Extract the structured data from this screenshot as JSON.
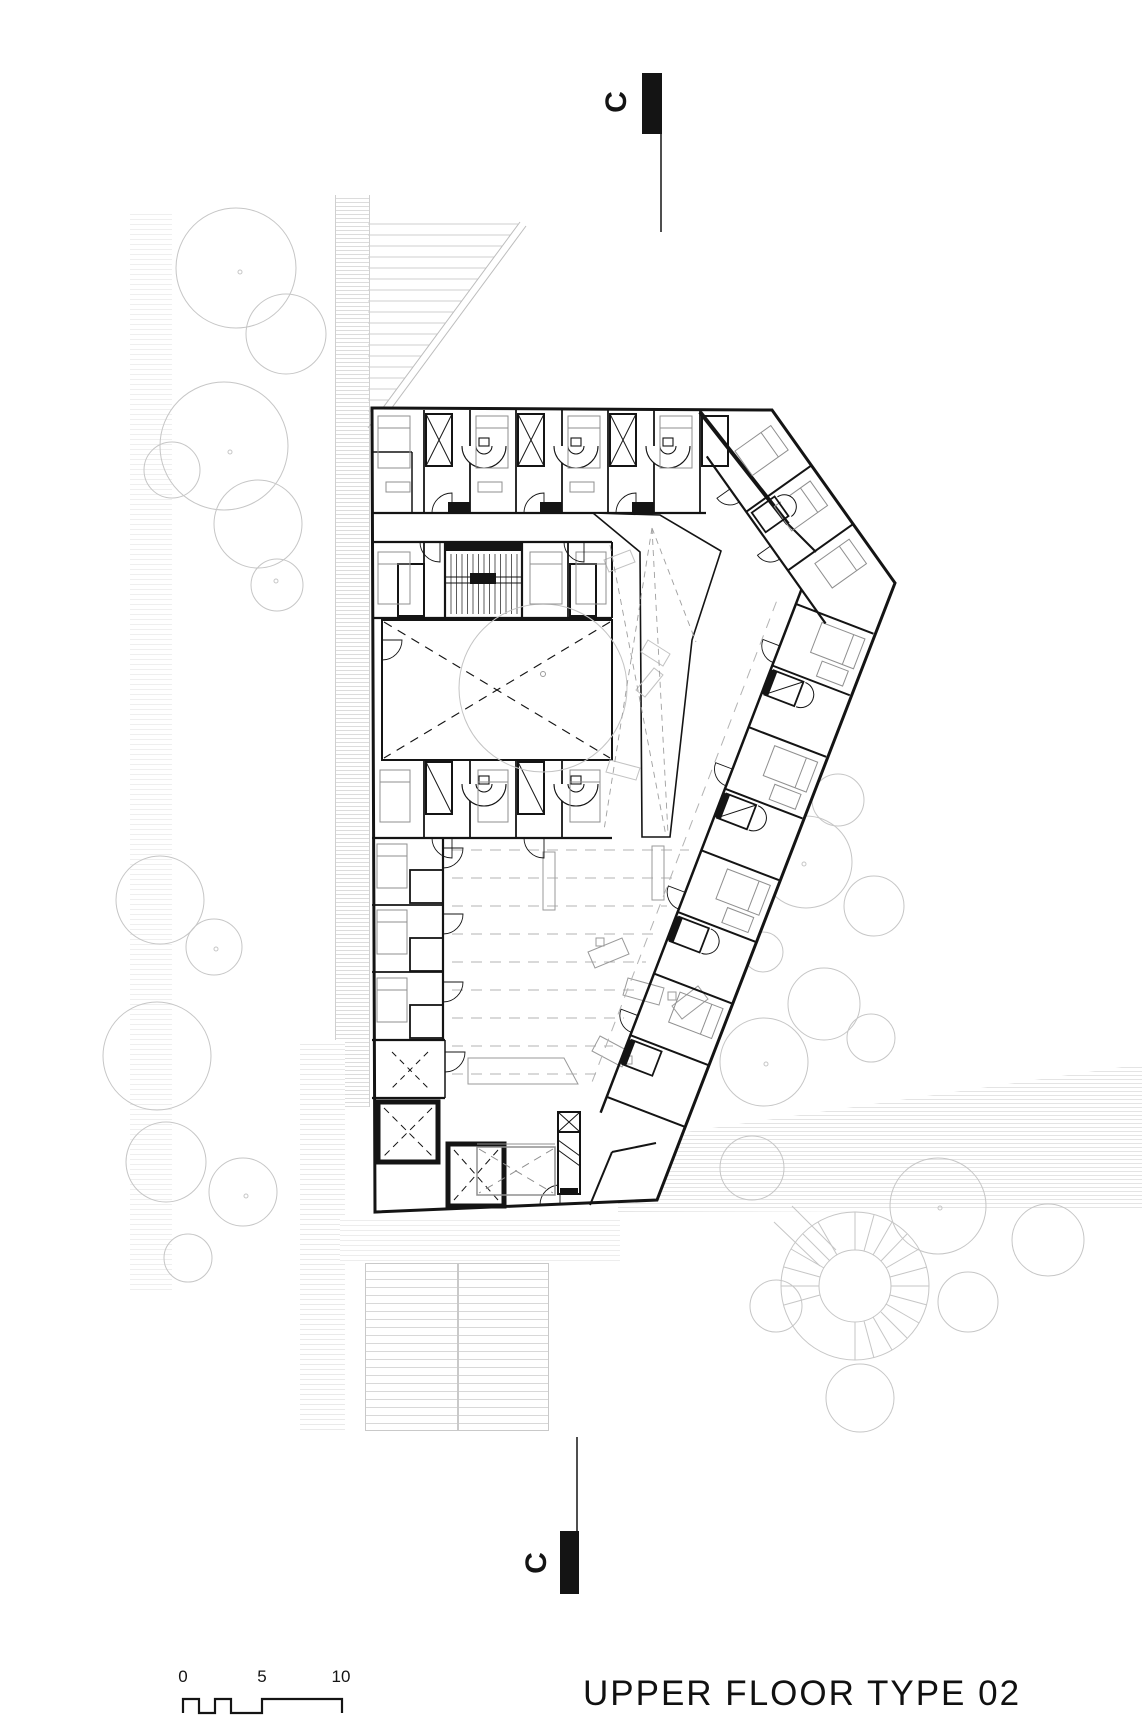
{
  "sheet": {
    "background": "#ffffff"
  },
  "titleblock": {
    "title": "UPPER FLOOR TYPE 02"
  },
  "scale_bar": {
    "tick_labels": [
      "0",
      "5",
      "10"
    ]
  },
  "section_markers": {
    "top_label": "C",
    "bottom_label": "C"
  },
  "palette": {
    "ink": "#141414",
    "wall": "#141414",
    "site_gray": "#c6c6c6",
    "furniture_gray": "#9a9a9a",
    "dash_gray": "#a8a8a8",
    "hatch_gray": "#dcdcdc"
  }
}
